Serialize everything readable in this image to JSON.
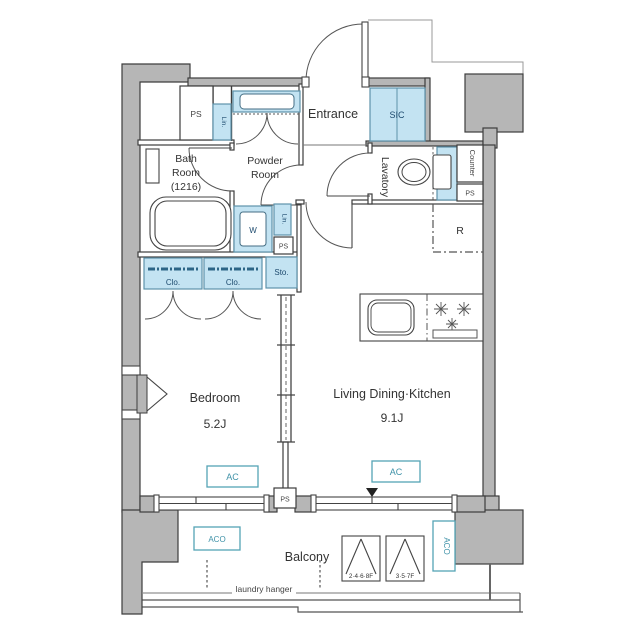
{
  "meta": {
    "title": "1LDK apartment floor plan",
    "canvas_px": 640
  },
  "colors": {
    "wall_fill": "#b6b6b6",
    "wall_stroke": "#3d3d3d",
    "fixture_blue_fill": "#c3e3f2",
    "fixture_blue_stroke": "#5d93ab",
    "fixture_label_navy": "#1d4a6e",
    "equipment_teal": "#3f92a8",
    "text_dark": "#333333"
  },
  "rooms": {
    "entrance": "Entrance",
    "shoe_closet": "SIC",
    "bath_line1": "Bath",
    "bath_line2": "Room",
    "bath_line3": "(1216)",
    "powder_line1": "Powder",
    "powder_line2": "Room",
    "lavatory": "Lavatory",
    "bedroom": "Bedroom",
    "bedroom_size": "5.2J",
    "ldk": "Living Dining·Kitchen",
    "ldk_size": "9.1J",
    "balcony": "Balcony"
  },
  "fixtures": {
    "pipe_space": "PS",
    "linen": "Lin.",
    "washer": "W",
    "closet": "Clo.",
    "storage": "Sto.",
    "counter": "Counter",
    "fridge": "R",
    "ac_unit": "AC",
    "ac_outdoor": "ACO",
    "laundry_hanger": "laundry hanger",
    "hatch_even_floors": "2·4·6·8F",
    "hatch_odd_floors": "3·5·7F"
  }
}
